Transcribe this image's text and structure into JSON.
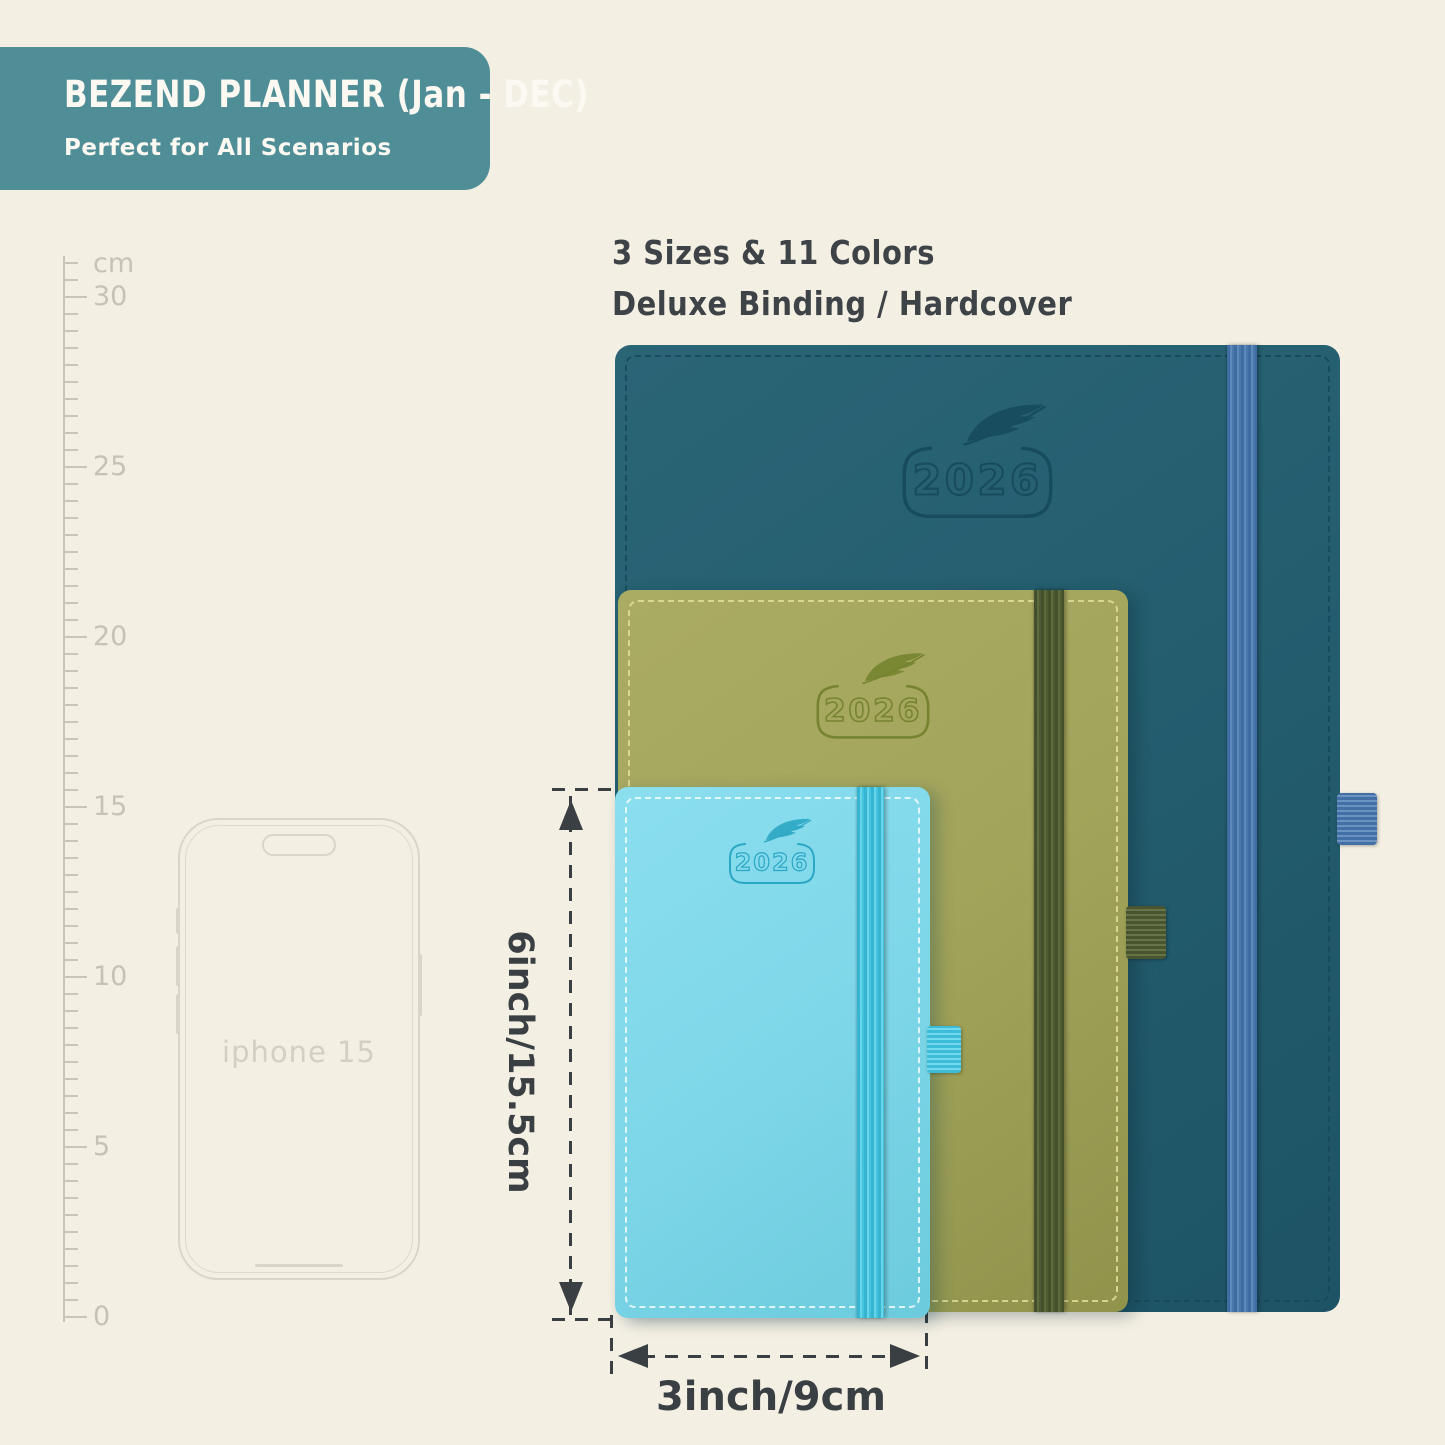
{
  "banner": {
    "title": "BEZEND PLANNER (Jan - DEC)",
    "subtitle": "Perfect for All Scenarios",
    "bg_color": "#4f8d97"
  },
  "headline": {
    "line1": "3 Sizes & 11 Colors",
    "line2": "Deluxe Binding / Hardcover"
  },
  "ruler": {
    "unit": "cm",
    "numbers": [
      "30",
      "25",
      "20",
      "15",
      "10",
      "5",
      "0"
    ]
  },
  "phone": {
    "label": "iphone 15"
  },
  "planners": [
    {
      "name": "large-teal",
      "year": "2026",
      "cover_color": "#245e6f",
      "band_color": "#4a7ab0"
    },
    {
      "name": "medium-olive",
      "year": "2026",
      "cover_color": "#a2a45b",
      "band_color": "#4d5931"
    },
    {
      "name": "small-blue",
      "year": "2026",
      "cover_color": "#7ed7e8",
      "band_color": "#3fc0dc"
    }
  ],
  "measurements": {
    "height_label": "6inch/15.5cm",
    "width_label": "3inch/9cm"
  },
  "colors": {
    "background": "#f3efe3",
    "text_dark": "#3e4347",
    "ruler_gray": "#c7c3b6",
    "phone_outline": "#d9d5c8"
  }
}
